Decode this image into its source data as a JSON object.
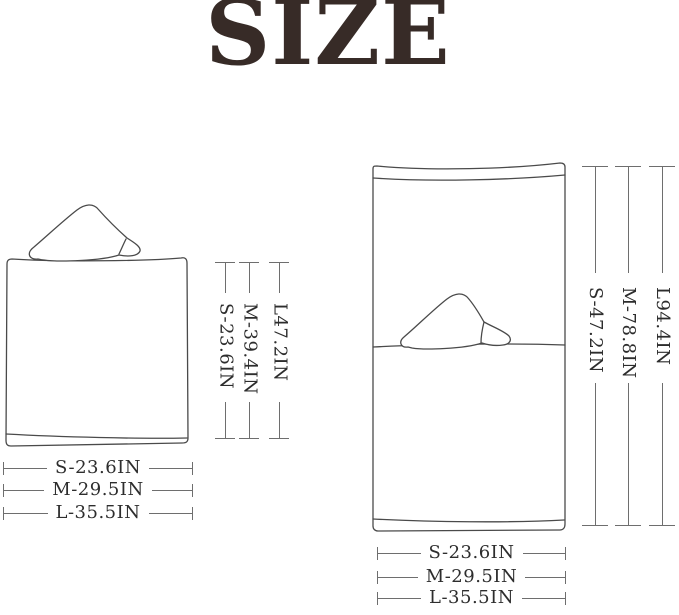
{
  "title": "SIZE",
  "unit": "IN",
  "colors": {
    "background": "#ffffff",
    "title_text": "#372b27",
    "drawing_line": "#4a4a4a",
    "dimension_line": "#6e6e6e",
    "dimension_text": "#2d2d2d"
  },
  "left_figure": {
    "description": "folded hooded towel front view",
    "height_labels": [
      "S-23.6IN",
      "M-39.4IN",
      "L47.2IN"
    ],
    "width_labels": [
      "S-23.6IN",
      "M-29.5IN",
      "L-35.5IN"
    ]
  },
  "right_figure": {
    "description": "unfolded hooded towel full length view",
    "height_labels": [
      "S-47.2IN",
      "M-78.8IN",
      "L94.4IN"
    ],
    "width_labels": [
      "S-23.6IN",
      "M-29.5IN",
      "L-35.5IN"
    ]
  }
}
